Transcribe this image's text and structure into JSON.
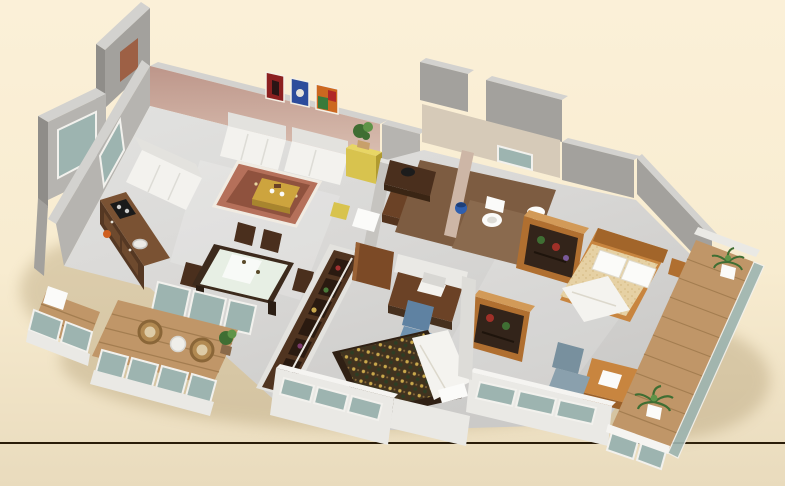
{
  "scene": {
    "kind": "3d-isometric-apartment-floorplan-render",
    "no_visible_text": true,
    "divider_line_y": 443,
    "rooms": [
      {
        "id": "living-room",
        "elements": [
          "accent-wall",
          "painting-red",
          "painting-blue",
          "painting-multicolor",
          "sofa-three-seater",
          "sofa-two-seater",
          "sofa-wall-left",
          "area-rug",
          "coffee-table",
          "yellow-sideboard",
          "potted-plant"
        ]
      },
      {
        "id": "kitchen",
        "elements": [
          "l-shaped-counter",
          "cooktop",
          "sink",
          "orange-pot",
          "window"
        ]
      },
      {
        "id": "dining-area",
        "elements": [
          "dining-table-glass-top",
          "dining-chairs-x4",
          "glass-partition"
        ]
      },
      {
        "id": "foyer-study",
        "elements": [
          "low-partition-wall",
          "study-desk",
          "tv-black",
          "white-bench",
          "yellow-stool"
        ]
      },
      {
        "id": "bathrooms",
        "elements": [
          "brown-tile-floor",
          "wood-vanity-black-basin",
          "toilet",
          "washbasin",
          "blue-bucket",
          "window"
        ]
      },
      {
        "id": "master-bedroom",
        "elements": [
          "wood-double-bed",
          "white-pillows",
          "beige-bedspread",
          "white-duvet",
          "open-shelf-wardrobe-x2",
          "nightstand",
          "office-chair",
          "writing-desk",
          "window-wall"
        ]
      },
      {
        "id": "middle-bedroom",
        "elements": [
          "double-bed-patterned-spread",
          "white-duvet",
          "bookshelf-divider",
          "laptop-desk",
          "blue-office-chair",
          "open-door",
          "window-wall"
        ]
      },
      {
        "id": "balcony-lower-left",
        "elements": [
          "wood-deck",
          "wicker-chair-x2",
          "round-table",
          "potted-plant",
          "glass-railing"
        ]
      },
      {
        "id": "balcony-left-small",
        "elements": [
          "wood-deck",
          "white-box-seat",
          "glass-railing"
        ]
      },
      {
        "id": "balcony-right",
        "elements": [
          "long-wood-plank-deck",
          "palm-plant-x2",
          "glass-railing",
          "parapet-wall"
        ]
      }
    ]
  },
  "colors": {
    "background_top": "#fbf0d8",
    "background_mid": "#f8ecd0",
    "background_bottom": "#e9dbbd",
    "divider_line": "#2a1c08",
    "wall_top": "#d3d2cf",
    "wall_gray": "#a3a19d",
    "wall_gray_light": "#b6b4b0",
    "accent_wall_top": "#bd968a",
    "accent_wall_bottom": "#dcc2b4",
    "outer_wall_white": "#eae9e5",
    "outer_wall_top": "#f5f4f1",
    "interior_floor": "#d9d8d6",
    "bathroom_tile": "#7d5c41",
    "wood_floor": "#c09668",
    "plank_line": "#a37d50",
    "glass": "#9db4b0",
    "glass_frame": "#f2f1ed",
    "dark_wood": "#4a2f1d",
    "medium_wood": "#6b4226",
    "orange_wood": "#b06f30",
    "orange_wood_light": "#d29a58",
    "sofa_white": "#f3f2ee",
    "sofa_shadow": "#e3e2de",
    "rug_red": "#b5705a",
    "rug_inner": "#8f523e",
    "coffee_table_gold": "#cda43e",
    "cabinet_yellow": "#d8c34e",
    "plant_green": "#3f6e33",
    "plant_green_light": "#5f9448",
    "bed_pattern_base": "#41331f",
    "bed_pattern_gold": "#c9a84c",
    "duvet_white": "#f4f3ef",
    "bed_beige": "#e6d1a4",
    "bed_frame_orange": "#c8853f",
    "headboard_orange": "#a2652a",
    "office_chair_blue": "#5f82a2",
    "office_chair_gray": "#78909e",
    "wicker_tan": "#b28a52",
    "wicker_rim": "#8a6638",
    "appliance_black": "#1a1a1a",
    "bucket_blue": "#2f5fae",
    "painting_red": "#8c2020",
    "painting_blue": "#2c4c9c",
    "painting_multicolor": "#cc6820",
    "porcelain_white": "#fbfbf9",
    "brown_window": "#9d6045",
    "shadow": "#9c8558"
  }
}
